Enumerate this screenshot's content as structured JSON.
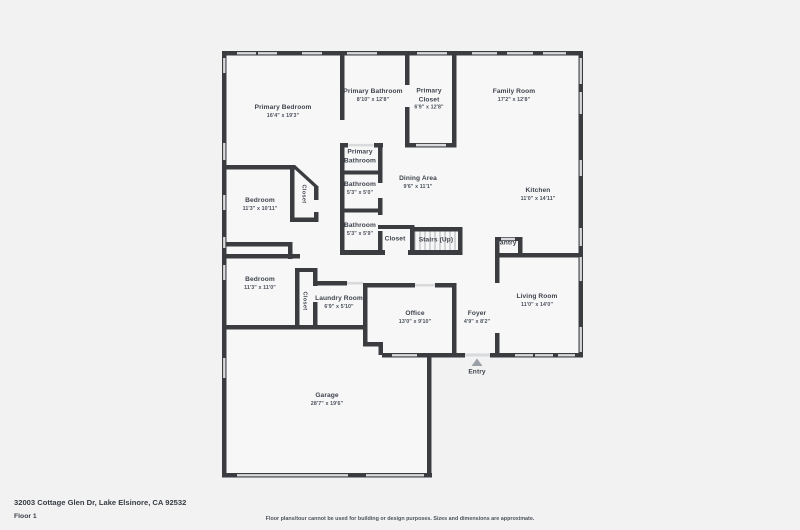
{
  "floor_plan": {
    "address": "32003 Cottage Glen Dr, Lake Elsinore, CA 92532",
    "floor_label": "Floor 1",
    "disclaimer": "Floor plans/tour cannot be used for building or design purposes. Sizes and dimensions are approximate.",
    "colors": {
      "wall": "#3a3c40",
      "window": "#d9dadc",
      "floor": "#f7f7f8",
      "page_bg": "#f2f2f3",
      "text": "#3f444c",
      "entry_arrow": "#9aa0a6"
    },
    "rooms": [
      {
        "id": "primary-bedroom",
        "name": "Primary Bedroom",
        "dims": "16'4\" x 19'3\"",
        "x": 283,
        "y": 112,
        "w": 110
      },
      {
        "id": "primary-bathroom",
        "name": "Primary Bathroom",
        "dims": "8'10\" x 12'8\"",
        "x": 373,
        "y": 96,
        "w": 110
      },
      {
        "id": "primary-closet",
        "name": "Primary Closet",
        "dims": "6'9\" x 12'8\"",
        "x": 429,
        "y": 100,
        "w": 34
      },
      {
        "id": "family-room",
        "name": "Family Room",
        "dims": "17'2\" x 12'8\"",
        "x": 514,
        "y": 96,
        "w": 110
      },
      {
        "id": "primary-bathroom-2",
        "name": "Primary Bathroom",
        "dims": "",
        "x": 360,
        "y": 157,
        "w": 34
      },
      {
        "id": "bathroom-1",
        "name": "Bathroom",
        "dims": "5'3\" x 5'0\"",
        "x": 360,
        "y": 189,
        "w": 40
      },
      {
        "id": "dining-area",
        "name": "Dining Area",
        "dims": "9'6\" x 11'1\"",
        "x": 418,
        "y": 183,
        "w": 100
      },
      {
        "id": "kitchen",
        "name": "Kitchen",
        "dims": "11'0\" x 14'11\"",
        "x": 538,
        "y": 195,
        "w": 100
      },
      {
        "id": "bathroom-2",
        "name": "Bathroom",
        "dims": "5'3\" x 5'9\"",
        "x": 360,
        "y": 230,
        "w": 40
      },
      {
        "id": "closet-primary-hall",
        "name": "Closet",
        "dims": "",
        "x": 303,
        "y": 194,
        "vertical": true
      },
      {
        "id": "bedroom-1",
        "name": "Bedroom",
        "dims": "11'3\" x 10'11\"",
        "x": 260,
        "y": 205,
        "w": 70
      },
      {
        "id": "bedroom-2",
        "name": "Bedroom",
        "dims": "11'3\" x 11'0\"",
        "x": 260,
        "y": 284,
        "w": 70
      },
      {
        "id": "closet-bedroom-2",
        "name": "Closet",
        "dims": "",
        "x": 304,
        "y": 301,
        "vertical": true
      },
      {
        "id": "laundry-room",
        "name": "Laundry Room",
        "dims": "6'9\" x 5'10\"",
        "x": 339,
        "y": 303,
        "w": 60
      },
      {
        "id": "closet-hall",
        "name": "Closet",
        "dims": "",
        "x": 395,
        "y": 240,
        "w": 30
      },
      {
        "id": "stairs",
        "name": "Stairs (Up)",
        "dims": "",
        "x": 436,
        "y": 241,
        "w": 60
      },
      {
        "id": "pantry",
        "name": "Pantry",
        "dims": "",
        "x": 506,
        "y": 244,
        "w": 30
      },
      {
        "id": "office",
        "name": "Office",
        "dims": "13'0\" x 9'10\"",
        "x": 415,
        "y": 318,
        "w": 80
      },
      {
        "id": "foyer",
        "name": "Foyer",
        "dims": "4'9\" x 8'2\"",
        "x": 477,
        "y": 318,
        "w": 44
      },
      {
        "id": "living-room",
        "name": "Living Room",
        "dims": "11'0\" x 14'0\"",
        "x": 537,
        "y": 301,
        "w": 90
      },
      {
        "id": "garage",
        "name": "Garage",
        "dims": "28'7\" x 19'6\"",
        "x": 327,
        "y": 400,
        "w": 110
      },
      {
        "id": "entry",
        "name": "Entry",
        "dims": "",
        "x": 477,
        "y": 373,
        "w": 40
      }
    ]
  }
}
